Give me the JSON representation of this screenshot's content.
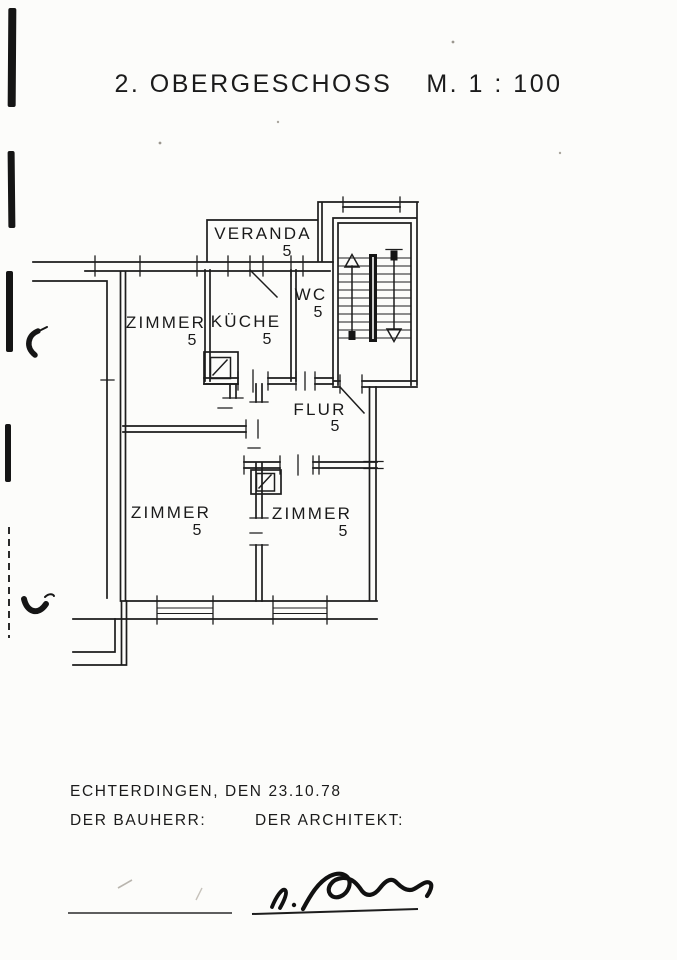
{
  "document": {
    "title_left": "2. OBERGESCHOSS",
    "title_right": "M. 1 : 100"
  },
  "plan": {
    "rooms": [
      {
        "id": "veranda",
        "label": "VERANDA",
        "number": "5"
      },
      {
        "id": "zimmer_top_left",
        "label": "ZIMMER",
        "number": "5"
      },
      {
        "id": "kueche",
        "label": "KÜCHE",
        "number": "5"
      },
      {
        "id": "wc",
        "label": "WC",
        "number": "5"
      },
      {
        "id": "flur",
        "label": "FLUR",
        "number": "5"
      },
      {
        "id": "zimmer_bottom_left",
        "label": "ZIMMER",
        "number": "5"
      },
      {
        "id": "zimmer_bottom_right",
        "label": "ZIMMER",
        "number": "5"
      }
    ],
    "stair_symbols": [
      "stair-up-arrow",
      "stair-down-arrow"
    ],
    "fixture_symbols": [
      "chimney-flue-symbol-kitchen",
      "chimney-flue-symbol-room"
    ]
  },
  "footer": {
    "place_date": "ECHTERDINGEN, DEN  23.10.78",
    "bauherr_label": "DER BAUHERR:",
    "architekt_label": "DER ARCHITEKT:"
  },
  "colors": {
    "ink": "#1d1d1d",
    "paper": "#fcfcfa"
  }
}
